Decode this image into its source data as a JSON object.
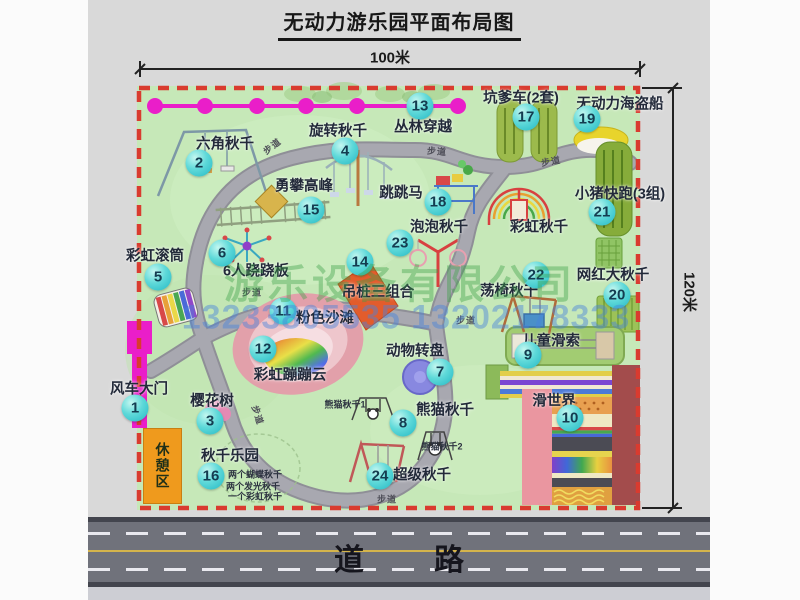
{
  "title": "无动力游乐园平面布局图",
  "dimensions": {
    "width_label": "100米",
    "height_label": "120米"
  },
  "road": {
    "label": "道路"
  },
  "rest_area": {
    "label": "休憩区"
  },
  "watermark": {
    "company": "游乐设备有限公司",
    "phone": "13233805535 13202178333"
  },
  "path_label_text": "步道",
  "path_labels": [
    {
      "x": 272,
      "y": 146,
      "r": -38
    },
    {
      "x": 437,
      "y": 151,
      "r": 4
    },
    {
      "x": 551,
      "y": 161,
      "r": -10
    },
    {
      "x": 252,
      "y": 292,
      "r": 0
    },
    {
      "x": 466,
      "y": 320,
      "r": 0
    },
    {
      "x": 258,
      "y": 415,
      "r": 72
    },
    {
      "x": 387,
      "y": 499,
      "r": 0
    }
  ],
  "attractions": [
    {
      "num": "1",
      "name": "风车大门",
      "lx": 139,
      "ly": 388,
      "bx": 135,
      "by": 408
    },
    {
      "num": "2",
      "name": "六角秋千",
      "lx": 225,
      "ly": 143,
      "bx": 199,
      "by": 163
    },
    {
      "num": "3",
      "name": "樱花树",
      "lx": 212,
      "ly": 400,
      "bx": 210,
      "by": 421
    },
    {
      "num": "4",
      "name": "旋转秋千",
      "lx": 338,
      "ly": 130,
      "bx": 345,
      "by": 151
    },
    {
      "num": "5",
      "name": "彩虹滚筒",
      "lx": 155,
      "ly": 255,
      "bx": 158,
      "by": 277
    },
    {
      "num": "6",
      "name": "6人跷跷板",
      "lx": 256,
      "ly": 270,
      "bx": 222,
      "by": 253
    },
    {
      "num": "7",
      "name": "动物转盘",
      "lx": 415,
      "ly": 350,
      "bx": 440,
      "by": 372
    },
    {
      "num": "8",
      "name": "熊猫秋千",
      "lx": 445,
      "ly": 409,
      "bx": 403,
      "by": 423
    },
    {
      "num": "9",
      "name": "儿童滑索",
      "lx": 551,
      "ly": 340,
      "bx": 528,
      "by": 355
    },
    {
      "num": "10",
      "name": "滑世界",
      "lx": 554,
      "ly": 400,
      "bx": 570,
      "by": 418
    },
    {
      "num": "11",
      "name": "粉色沙滩",
      "lx": 325,
      "ly": 317,
      "bx": 283,
      "by": 311
    },
    {
      "num": "12",
      "name": "彩虹蹦蹦云",
      "lx": 290,
      "ly": 374,
      "bx": 263,
      "by": 349
    },
    {
      "num": "13",
      "name": "丛林穿越",
      "lx": 423,
      "ly": 126,
      "bx": 420,
      "by": 106
    },
    {
      "num": "14",
      "name": "吊桩三组合",
      "lx": 378,
      "ly": 291,
      "bx": 360,
      "by": 262
    },
    {
      "num": "15",
      "name": "勇攀高峰",
      "lx": 304,
      "ly": 185,
      "bx": 311,
      "by": 210
    },
    {
      "num": "16",
      "name": "秋千乐园",
      "lx": 230,
      "ly": 455,
      "bx": 211,
      "by": 476
    },
    {
      "num": "17",
      "name": "坑爹车(2套)",
      "lx": 521,
      "ly": 97,
      "bx": 526,
      "by": 117
    },
    {
      "num": "18",
      "name": "跳跳马",
      "lx": 401,
      "ly": 192,
      "bx": 438,
      "by": 202
    },
    {
      "num": "19",
      "name": "无动力海盗船",
      "lx": 620,
      "ly": 103,
      "bx": 587,
      "by": 119
    },
    {
      "num": "20",
      "name": "网红大秋千",
      "lx": 613,
      "ly": 274,
      "bx": 617,
      "by": 295
    },
    {
      "num": "21",
      "name": "小猪快跑(3组)",
      "lx": 620,
      "ly": 193,
      "bx": 602,
      "by": 212
    },
    {
      "num": "22",
      "name": "荡椅秋千",
      "lx": 509,
      "ly": 290,
      "bx": 536,
      "by": 275
    },
    {
      "num": "23",
      "name": "泡泡秋千",
      "lx": 439,
      "ly": 226,
      "bx": 400,
      "by": 243
    },
    {
      "num": "24",
      "name": "超级秋千",
      "lx": 422,
      "ly": 474,
      "bx": 380,
      "by": 476
    },
    {
      "num": null,
      "name": "彩虹秋千",
      "lx": 539,
      "ly": 226
    }
  ],
  "swing_park_notes": [
    {
      "text": "两个蝴蝶秋千",
      "x": 228,
      "y": 474
    },
    {
      "text": "两个发光秋千",
      "x": 226,
      "y": 486
    },
    {
      "text": "一个彩虹秋千",
      "x": 228,
      "y": 496
    }
  ],
  "panda_sublabels": [
    {
      "text": "熊猫秋千1",
      "x": 345,
      "y": 404
    },
    {
      "text": "熊猫秋千2",
      "x": 442,
      "y": 446
    }
  ],
  "colors": {
    "badge_cyan": "#35cfd1",
    "boundary_red": "#d93b2f",
    "zipline_magenta": "#ea1ec9",
    "ground_green": "#c6e8b8",
    "road_gray": "#70727b"
  }
}
